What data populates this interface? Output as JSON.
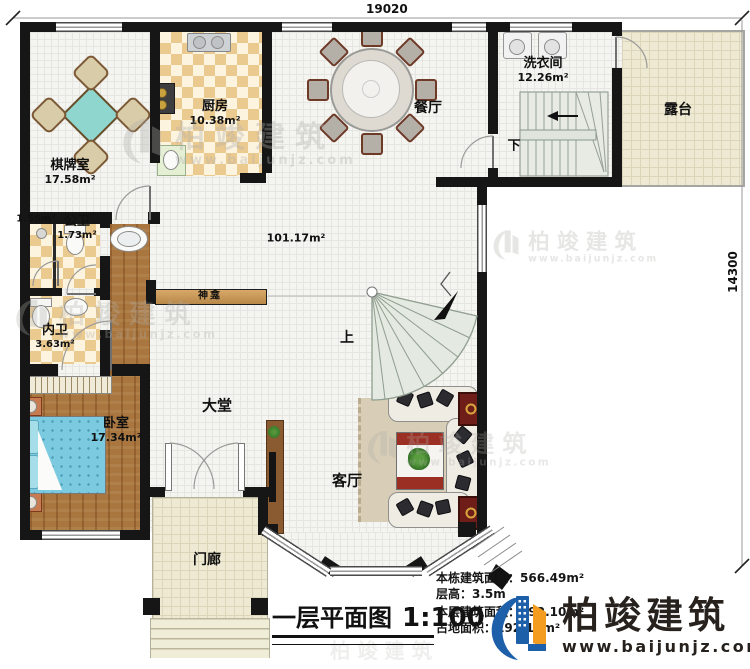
{
  "dimensions": {
    "width": "19020",
    "height": "14300"
  },
  "rooms": {
    "chess": {
      "name": "棋牌室",
      "area": "17.58m²"
    },
    "kitchen": {
      "name": "厨房",
      "area": "10.38m²"
    },
    "dining": {
      "name": "餐厅"
    },
    "laundry": {
      "name": "洗衣间",
      "area": "12.26m²"
    },
    "terrace": {
      "name": "露台"
    },
    "open_area": {
      "area": "101.17m²"
    },
    "shower_room": {
      "area": "1.56m²"
    },
    "public_bath": {
      "name": "公卫",
      "area": "1.73m²"
    },
    "inner_bath": {
      "name": "内卫",
      "area": "3.63m²"
    },
    "bedroom": {
      "name": "卧室",
      "area": "17.34m²"
    },
    "lobby": {
      "name": "大堂"
    },
    "living": {
      "name": "客厅"
    },
    "porch": {
      "name": "门廊"
    },
    "shrine": {
      "name": "神龛"
    }
  },
  "stairs": {
    "up": "上",
    "down": "下"
  },
  "title": {
    "name": "一层平面图",
    "scale": "1:100"
  },
  "info": {
    "lines": [
      {
        "label": "本栋建筑面积：",
        "value": "566.49m²"
      },
      {
        "label": "层高：",
        "value": "3.5m"
      },
      {
        "label": "本层建筑面积：",
        "value": "192.10m²"
      },
      {
        "label": "占地面积：",
        "value": "192.10m²"
      }
    ]
  },
  "brand": {
    "name": "柏竣建筑",
    "website": "www.baijunjz.com"
  },
  "watermark": {
    "name": "柏竣建筑",
    "website": "www.baijunjz.com"
  },
  "icons": {
    "logo": "baijun-building-glyph"
  },
  "colors": {
    "wall": "#161616",
    "logo_blue": "#1d5fa9",
    "logo_orange": "#f49c1f",
    "wood": "#a9763f",
    "bed": "#7ccadf",
    "tile_checker": "#ebca90",
    "terrace_floor": "#ede9d2",
    "stair": "#e4e9e1",
    "shrine_bar": "#c89055"
  }
}
